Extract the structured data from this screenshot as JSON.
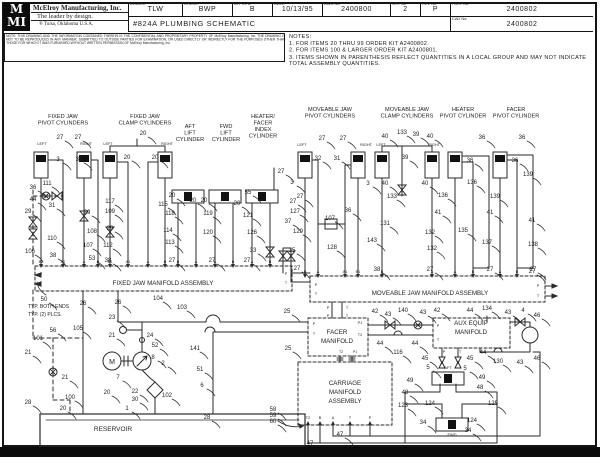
{
  "title_block": {
    "logo_top": "M",
    "logo_bottom": "MI",
    "company": "McElroy Manufacturing, Inc.",
    "tagline": "The leader by design.",
    "location": "®   Tulsa, Oklahoma U.S.A.",
    "drawing_title": "#824A PLUMBING SCHEMATIC",
    "fields": {
      "drawn_label": "DRAWN:",
      "drawn": "TLW",
      "check_label": "CHECK:",
      "check": "BWP",
      "apprvd_label": "APPRV'D:",
      "apprvd": "B",
      "date_label": "DATE:",
      "date": "10/13/95",
      "dwg_label": "DWG No:",
      "dwg": "2400800",
      "sht_label": "SHT No:",
      "sht": "2",
      "rev_label": "REV No:",
      "rev": "P",
      "part_label": "PART No:",
      "part": "2400802",
      "cad_label": "CAD No:",
      "cad": "2400802"
    }
  },
  "notice": "NOTE: THIS DRAWING AND THE INFORMATION CONTAINED THEREIN IS THE CONFIDENTIAL AND PROPRIETARY PROPERTY OF McElroy Manufacturing, Inc. THE DRAWING IS NOT TO BE REPRODUCED IN ANY MANNER, SUBMITTED TO OUTSIDE PARTIES FOR EXAMINATION, OR USED DIRECTLY OR INDIRECTLY FOR THE PURPOSES OTHER THAN THOSE FOR WHICH IT WAS FURNISHED WITHOUT WRITTEN PERMISSION OF McElroy Manufacturing, Inc.",
  "notes": {
    "heading": "NOTES:",
    "items": [
      "1. FOR ITEMS 20 THRU 99 ORDER KIT A2400802.",
      "2. FOR ITEMS 100 & LARGER ORDER KIT A2400801.",
      "3. ITEMS SHOWN IN PARENTHESIS REFLECT QUANTITIES IN A LOCAL GROUP AND MAY NOT INDICATE TOTAL ASSEMBLY QUANTITIES."
    ]
  },
  "schematic": {
    "group_labels": [
      {
        "lines": [
          "FIXED JAW",
          "PIVOT CYLINDERS"
        ],
        "x": 63,
        "y": 118
      },
      {
        "lines": [
          "FIXED JAW",
          "CLAMP CYLINDERS"
        ],
        "x": 145,
        "y": 118
      },
      {
        "lines": [
          "AFT",
          "LIFT",
          "CYLINDER"
        ],
        "x": 190,
        "y": 128
      },
      {
        "lines": [
          "FWD",
          "LIFT",
          "CYLINDER"
        ],
        "x": 226,
        "y": 128
      },
      {
        "lines": [
          "HEATER/",
          "FACER",
          "INDEX",
          "CYLINDER"
        ],
        "x": 263,
        "y": 118
      },
      {
        "lines": [
          "MOVEABLE JAW",
          "PIVOT CYLINDERS"
        ],
        "x": 330,
        "y": 111
      },
      {
        "lines": [
          "MOVEABLE JAW",
          "CLAMP CYLINDERS"
        ],
        "x": 407,
        "y": 111
      },
      {
        "lines": [
          "HEATER",
          "PIVOT CYLINDER"
        ],
        "x": 463,
        "y": 111
      },
      {
        "lines": [
          "FACER",
          "PIVOT CYLINDER"
        ],
        "x": 516,
        "y": 111
      }
    ],
    "side_labels": [
      [
        "LEFT",
        42,
        145
      ],
      [
        "RIGHT",
        86,
        145
      ],
      [
        "LEFT",
        108,
        145
      ],
      [
        "RIGHT",
        167,
        145
      ],
      [
        "LEFT",
        302,
        146
      ],
      [
        "RIGHT",
        366,
        146
      ],
      [
        "LEFT",
        381,
        146
      ],
      [
        "RIGHT",
        434,
        146
      ]
    ],
    "manifolds": [
      {
        "name": "fixed-jaw-manifold",
        "label_lines": [
          "FIXED JAW MANIFOLD ASSEMBLY"
        ],
        "cx": 163,
        "cy": 285,
        "top_y": 266,
        "dir": "down",
        "ports": [
          [
            "B2",
            41
          ],
          [
            "A2",
            63
          ],
          [
            "A",
            84
          ],
          [
            "B",
            98
          ],
          [
            "B1",
            110
          ],
          [
            "A1",
            128
          ],
          [
            "A",
            148
          ],
          [
            "B",
            165
          ],
          [
            "B",
            178
          ],
          [
            "A",
            196
          ],
          [
            "A",
            215
          ],
          [
            "B",
            233
          ],
          [
            "A",
            252
          ],
          [
            "B",
            270
          ]
        ],
        "side": [
          [
            "P",
            41,
            275
          ],
          [
            "T",
            41,
            284
          ],
          [
            "P",
            286,
            275
          ],
          [
            "T",
            286,
            284
          ]
        ]
      },
      {
        "name": "moveable-jaw-manifold",
        "label_lines": [
          "MOVEABLE JAW MANIFOLD ASSEMBLY"
        ],
        "cx": 430,
        "cy": 295,
        "top_y": 276,
        "dir": "down",
        "ports": [
          [
            "B",
            305
          ],
          [
            "A",
            318
          ],
          [
            "A1",
            345
          ],
          [
            "B1",
            358
          ],
          [
            "B",
            382
          ],
          [
            "A",
            432
          ],
          [
            "A",
            455
          ],
          [
            "B",
            473
          ],
          [
            "A",
            500
          ],
          [
            "B",
            517
          ]
        ],
        "side": [
          [
            "P",
            316,
            286
          ],
          [
            "T",
            316,
            295
          ],
          [
            "P",
            538,
            287
          ],
          [
            "T",
            538,
            297
          ],
          [
            "P",
            328,
            309
          ],
          [
            "T",
            347,
            309
          ],
          [
            "P",
            328,
            317
          ],
          [
            "T",
            347,
            317
          ]
        ]
      },
      {
        "name": "facer-manifold",
        "label_lines": [
          "FACER",
          "MANIFOLD"
        ],
        "cx": 337,
        "cy": 334,
        "top_y": 0,
        "dir": "none",
        "ports": [],
        "side": [
          [
            "P",
            314,
            325
          ],
          [
            "T",
            314,
            335
          ],
          [
            "P1",
            360,
            324
          ],
          [
            "T2",
            360,
            336
          ]
        ]
      },
      {
        "name": "aux-equip-manifold",
        "label_lines": [
          "AUX EQUIP",
          "MANIFOLD"
        ],
        "cx": 471,
        "cy": 325,
        "top_y": 0,
        "dir": "none",
        "ports": [],
        "side": [
          [
            "P",
            438,
            327
          ],
          [
            "T",
            438,
            341
          ],
          [
            "P",
            444,
            353
          ],
          [
            "T",
            460,
            353
          ]
        ]
      },
      {
        "name": "carriage-manifold",
        "label_lines": [
          "CARRIAGE",
          "MANIFOLD",
          "ASSEMBLY"
        ],
        "cx": 345,
        "cy": 385,
        "top_y": 425,
        "dir": "up",
        "ports": [
          [
            "T2",
            308
          ],
          [
            "B",
            320
          ],
          [
            "A",
            333
          ],
          [
            "T",
            350
          ],
          [
            "P",
            370
          ]
        ],
        "side": []
      }
    ],
    "misc_labels": [
      [
        "RESERVOIR",
        113,
        431,
        6.5,
        "middle"
      ],
      [
        "AFT",
        448,
        369,
        4,
        "middle"
      ],
      [
        "FWD",
        452,
        436,
        4,
        "middle"
      ],
      [
        "TYP. BOTH ENDS",
        28,
        308,
        5,
        "start"
      ],
      [
        "TYP. (2) PLCS.",
        28,
        316,
        5,
        "start"
      ],
      [
        "T2",
        341,
        353,
        3.5,
        "middle"
      ],
      [
        "P1",
        355,
        353,
        3.5,
        "middle"
      ]
    ],
    "callouts": [
      [
        "27",
        60,
        137
      ],
      [
        "27",
        78,
        137
      ],
      [
        "3",
        58,
        159
      ],
      [
        "32",
        79,
        159
      ],
      [
        "20",
        143,
        133
      ],
      [
        "20",
        127,
        157
      ],
      [
        "20",
        155,
        157
      ],
      [
        "111",
        47,
        183
      ],
      [
        "36",
        33,
        187
      ],
      [
        "44",
        33,
        199
      ],
      [
        "31",
        52,
        205
      ],
      [
        "29",
        28,
        211
      ],
      [
        "29",
        87,
        212
      ],
      [
        "117",
        110,
        201
      ],
      [
        "109",
        110,
        211
      ],
      [
        "29",
        110,
        228
      ],
      [
        "110",
        52,
        238
      ],
      [
        "108",
        92,
        231
      ],
      [
        "107",
        88,
        245
      ],
      [
        "112",
        108,
        245
      ],
      [
        "53",
        92,
        258
      ],
      [
        "106",
        30,
        251
      ],
      [
        "38",
        53,
        255
      ],
      [
        "38",
        108,
        260
      ],
      [
        "20",
        172,
        195
      ],
      [
        "115",
        163,
        204
      ],
      [
        "118",
        170,
        213
      ],
      [
        "114",
        168,
        230
      ],
      [
        "113",
        170,
        242
      ],
      [
        "27",
        172,
        260
      ],
      [
        "20",
        193,
        200
      ],
      [
        "20",
        204,
        200
      ],
      [
        "119",
        208,
        213
      ],
      [
        "120",
        208,
        232
      ],
      [
        "27",
        212,
        260
      ],
      [
        "20",
        237,
        203
      ],
      [
        "121",
        248,
        215
      ],
      [
        "126",
        252,
        232
      ],
      [
        "27",
        247,
        260
      ],
      [
        "55",
        248,
        192
      ],
      [
        "127",
        295,
        211
      ],
      [
        "37",
        288,
        221
      ],
      [
        "33",
        253,
        250
      ],
      [
        "35",
        292,
        250
      ],
      [
        "27",
        281,
        171
      ],
      [
        "129",
        298,
        231
      ],
      [
        "27",
        322,
        138
      ],
      [
        "27",
        343,
        138
      ],
      [
        "32",
        318,
        158
      ],
      [
        "31",
        337,
        158
      ],
      [
        "3",
        292,
        182
      ],
      [
        "3",
        368,
        183
      ],
      [
        "27",
        300,
        196
      ],
      [
        "27",
        293,
        201
      ],
      [
        "36",
        348,
        210
      ],
      [
        "107",
        330,
        218
      ],
      [
        "143",
        372,
        240
      ],
      [
        "128",
        332,
        247
      ],
      [
        "40",
        385,
        136
      ],
      [
        "133",
        402,
        132
      ],
      [
        "39",
        416,
        134
      ],
      [
        "40",
        430,
        136
      ],
      [
        "39",
        405,
        157
      ],
      [
        "40",
        385,
        183
      ],
      [
        "40",
        425,
        183
      ],
      [
        "133",
        392,
        196
      ],
      [
        "131",
        385,
        223
      ],
      [
        "132",
        430,
        232
      ],
      [
        "132",
        432,
        248
      ],
      [
        "36",
        482,
        137
      ],
      [
        "36",
        470,
        160
      ],
      [
        "136",
        472,
        182
      ],
      [
        "136",
        443,
        195
      ],
      [
        "41",
        438,
        212
      ],
      [
        "41",
        490,
        212
      ],
      [
        "135",
        463,
        230
      ],
      [
        "137",
        487,
        242
      ],
      [
        "36",
        522,
        137
      ],
      [
        "36",
        515,
        160
      ],
      [
        "139",
        528,
        174
      ],
      [
        "139",
        495,
        196
      ],
      [
        "41",
        532,
        220
      ],
      [
        "138",
        533,
        244
      ],
      [
        "27",
        532,
        271
      ],
      [
        "38",
        377,
        269
      ],
      [
        "27",
        430,
        269
      ],
      [
        "27",
        490,
        269
      ],
      [
        "27",
        533,
        269
      ],
      [
        "27",
        297,
        268
      ],
      [
        "50",
        44,
        299
      ],
      [
        "26",
        83,
        303
      ],
      [
        "26",
        118,
        302
      ],
      [
        "104",
        158,
        298
      ],
      [
        "103",
        182,
        307
      ],
      [
        "23",
        112,
        317
      ],
      [
        "25",
        287,
        311
      ],
      [
        "25",
        288,
        348
      ],
      [
        "105",
        78,
        328
      ],
      [
        "56",
        53,
        330
      ],
      [
        "101",
        38,
        338
      ],
      [
        "21",
        28,
        352
      ],
      [
        "21",
        65,
        377
      ],
      [
        "21",
        112,
        335
      ],
      [
        "24",
        150,
        335
      ],
      [
        "52",
        155,
        345
      ],
      [
        "8",
        153,
        357
      ],
      [
        "2",
        163,
        363
      ],
      [
        "7",
        118,
        377
      ],
      [
        "22",
        135,
        391
      ],
      [
        "30",
        135,
        399
      ],
      [
        "102",
        167,
        395
      ],
      [
        "1",
        127,
        408
      ],
      [
        "100",
        70,
        397
      ],
      [
        "28",
        28,
        402
      ],
      [
        "20",
        63,
        408
      ],
      [
        "20",
        107,
        392
      ],
      [
        "141",
        195,
        348
      ],
      [
        "51",
        200,
        369
      ],
      [
        "6",
        202,
        385
      ],
      [
        "28",
        207,
        417
      ],
      [
        "58",
        273,
        409
      ],
      [
        "59",
        273,
        415
      ],
      [
        "60",
        273,
        421
      ],
      [
        "42",
        375,
        311
      ],
      [
        "43",
        388,
        314
      ],
      [
        "140",
        403,
        310
      ],
      [
        "43",
        423,
        312
      ],
      [
        "42",
        437,
        310
      ],
      [
        "44",
        470,
        310
      ],
      [
        "134",
        487,
        308
      ],
      [
        "43",
        508,
        312
      ],
      [
        "4",
        523,
        310
      ],
      [
        "46",
        537,
        315
      ],
      [
        "44",
        380,
        343
      ],
      [
        "116",
        398,
        352
      ],
      [
        "44",
        415,
        343
      ],
      [
        "45",
        425,
        358
      ],
      [
        "45",
        470,
        358
      ],
      [
        "44",
        483,
        352
      ],
      [
        "130",
        498,
        361
      ],
      [
        "43",
        520,
        362
      ],
      [
        "46",
        537,
        358
      ],
      [
        "5",
        428,
        367
      ],
      [
        "5",
        465,
        368
      ],
      [
        "49",
        410,
        380
      ],
      [
        "49",
        482,
        377
      ],
      [
        "48",
        480,
        387
      ],
      [
        "48",
        405,
        392
      ],
      [
        "123",
        403,
        405
      ],
      [
        "124",
        430,
        403
      ],
      [
        "125",
        493,
        403
      ],
      [
        "34",
        423,
        422
      ],
      [
        "124",
        472,
        420
      ],
      [
        "34",
        468,
        430
      ],
      [
        "47",
        340,
        434
      ],
      [
        "47",
        310,
        443
      ]
    ],
    "colors": {
      "line": "#2a2a2a",
      "text": "#222222",
      "bar": "#0b0b0b"
    }
  }
}
